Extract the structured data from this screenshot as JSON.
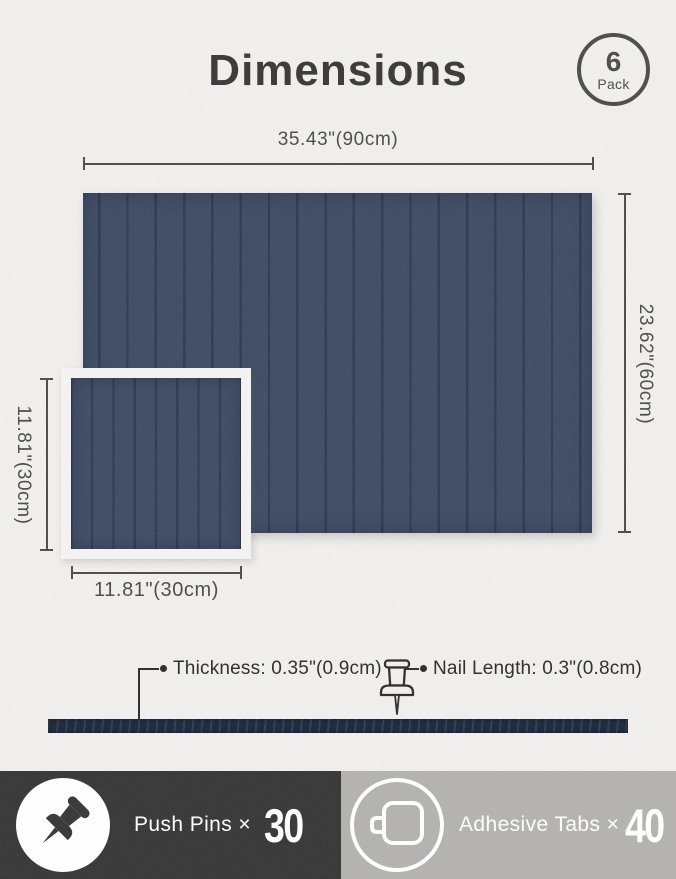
{
  "colors": {
    "paper": "#f1f0ee",
    "panel": "#3d4a61",
    "groove": "#2c394f",
    "strip": "#1c2539",
    "ink": "#3a3a3a",
    "dim": "#4d4d4d",
    "leader": "#2e2e2e",
    "footer_dark": "#393838",
    "footer_gray": "#b5b3b0"
  },
  "header": {
    "title": "Dimensions",
    "badge": {
      "count": "6",
      "label": "Pack"
    }
  },
  "dimensions": {
    "large_panel": {
      "width_label": "35.43\"(90cm)",
      "height_label": "23.62\"(60cm)"
    },
    "small_panel": {
      "height_label": "11.81\"(30cm)",
      "width_label": "11.81\"(30cm)"
    }
  },
  "annotations": {
    "thickness": "Thickness: 0.35\"(0.9cm)",
    "nail_length": "Nail Length: 0.3\"(0.8cm)"
  },
  "footer": {
    "push_pins": {
      "icon": "push-pin-icon",
      "label": "Push Pins ×",
      "count": "30"
    },
    "adhesive_tabs": {
      "icon": "adhesive-tab-icon",
      "label": "Adhesive Tabs ×",
      "count": "40"
    }
  }
}
